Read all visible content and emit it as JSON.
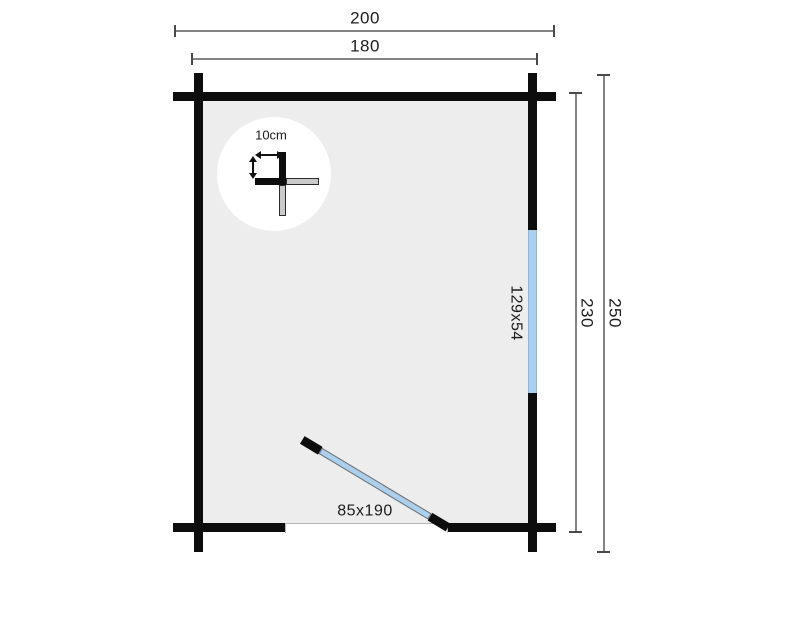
{
  "diagram": {
    "type": "floor-plan",
    "top_dimensions": [
      {
        "id": "outer-width",
        "label": "200"
      },
      {
        "id": "inner-width",
        "label": "180"
      }
    ],
    "right_dimensions": [
      {
        "id": "inner-depth",
        "label": "230"
      },
      {
        "id": "outer-depth",
        "label": "250"
      }
    ],
    "window": {
      "label": "129x54"
    },
    "door": {
      "label": "85x190"
    },
    "wall_detail": {
      "label": "10cm"
    },
    "colors": {
      "wall": "#0d0d0d",
      "floor": "#ededed",
      "glazing": "#abcfec",
      "dimension_line": "#828282",
      "text": "#1c1c1c"
    }
  }
}
